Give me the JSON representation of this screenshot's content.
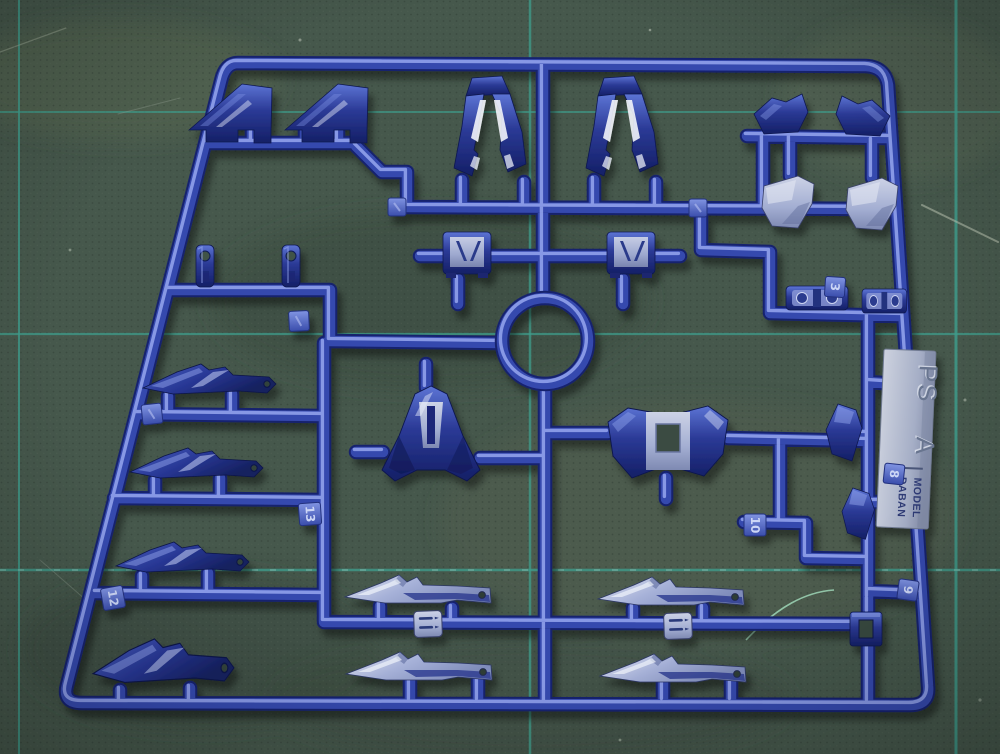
{
  "molding_tag": {
    "material": "PS",
    "runner_letter": "A",
    "brand_line1": "DABAN",
    "brand_line2": "MODEL"
  },
  "part_number_tags": {
    "3": "3",
    "8": "8",
    "9": "9",
    "10": "10",
    "12": "12",
    "13": "13"
  },
  "colors": {
    "mat_green": "#46584c",
    "mat_grid_teal": "#3f9c8b",
    "runner_blue": "#3649ae",
    "runner_dark": "#18236e",
    "runner_highlight": "#9cadf2",
    "part_navy": "#1b2878",
    "part_steel": "#a8b2d8",
    "tag_plate": "#c9cedd",
    "number_tag_blue": "#4e63c4"
  }
}
